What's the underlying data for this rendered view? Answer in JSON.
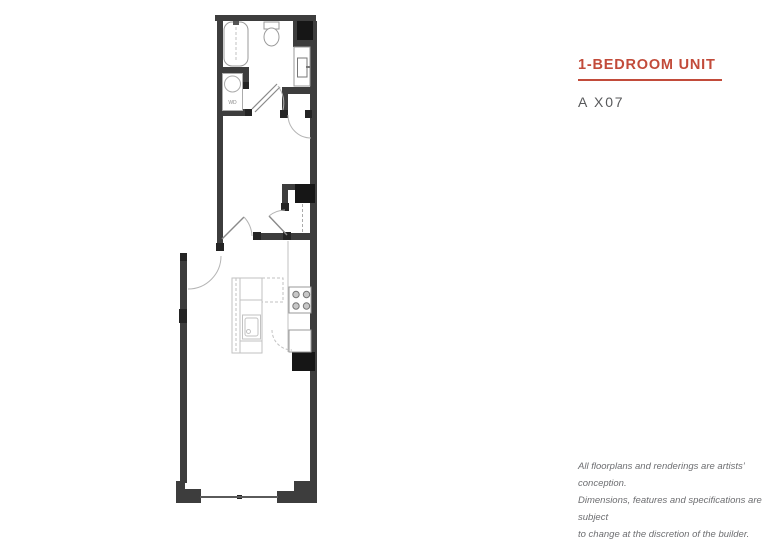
{
  "header": {
    "title": "1-BEDROOM UNIT",
    "unit_code": "A X07"
  },
  "floorplan": {
    "description": "1-bedroom unit floor plan",
    "wd_label": "WD",
    "fixtures": [
      "bathtub",
      "toilet",
      "sink-vanity",
      "washer-dryer",
      "kitchen-island",
      "island-sink",
      "stove",
      "base-cabinet",
      "upper-cabinets",
      "shafts",
      "window-wall"
    ]
  },
  "disclaimer": {
    "lines": [
      "All floorplans and renderings are artists’ conception.",
      "Dimensions, features and specifications are subject",
      "to change at the discretion of the builder."
    ]
  },
  "colors": {
    "accent_red": "#C24B3A",
    "wall_gray": "#3D3D3D",
    "post_gray": "#242424",
    "shaft_black": "#161616",
    "fixture_gray": "#9A9A9A",
    "counter_gray": "#C2C2C2",
    "swing_gray": "#B5B5B5",
    "unit_code_gray": "#58595B",
    "disclaimer_gray": "#6D6E71"
  }
}
